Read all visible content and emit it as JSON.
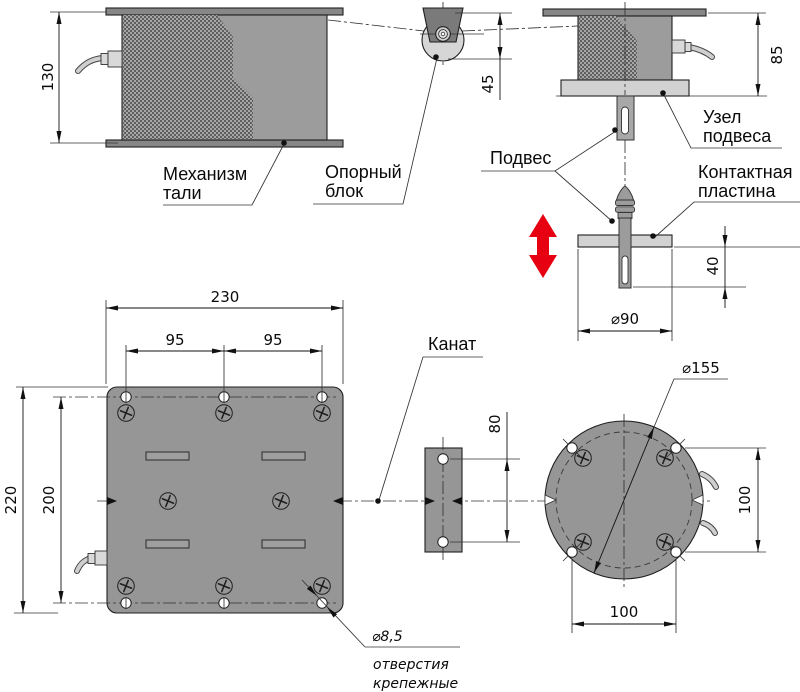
{
  "drawing_labels": {
    "hoist_mechanism_1": "Механизм",
    "hoist_mechanism_2": "тали",
    "support_block_1": "Опорный",
    "support_block_2": "блок",
    "suspension_unit_1": "Узел",
    "suspension_unit_2": "подвеса",
    "suspension": "Подвес",
    "contact_plate_1": "Контактная",
    "contact_plate_2": "пластина",
    "rope": "Канат",
    "mount_holes_dia": "⌀8,5",
    "mount_holes_note_1": "отверстия",
    "mount_holes_note_2": "крепежные"
  },
  "dimensions": {
    "hoist_height": "130",
    "pulley_drop": "45",
    "unit_height": "85",
    "pin_length_below_plate": "40",
    "contact_plate_diameter": "⌀90",
    "base_plate_width": "230",
    "hole_pitch_left": "95",
    "hole_pitch_right": "95",
    "base_plate_height": "220",
    "hole_span_vertical": "200",
    "guide_hole_pitch": "80",
    "flange_diameter": "⌀155",
    "flange_hole_pitch_vertical": "100",
    "flange_hole_pitch_horizontal": "100"
  },
  "colors": {
    "accent_red": "#e60012",
    "body_gray": "#9c9c9c",
    "plate_gray": "#969696",
    "flange_plate_gray": "#878787",
    "light_plate_gray": "#d2d2d2",
    "line_color": "#1f1f1f"
  }
}
